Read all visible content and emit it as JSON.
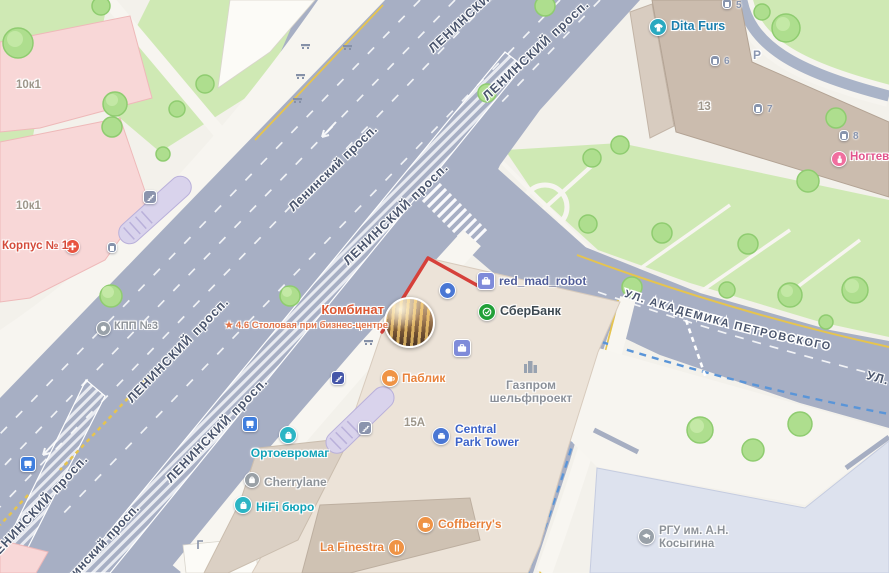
{
  "map_title": "Yandex-style city map, Leninsky Prospekt intersection",
  "roads": {
    "leninsky_caps": "ЛЕНИНСКИЙ просп.",
    "leninsky_title": "Ленинский просп.",
    "leninsky_short": "ЛЕНИНСКИЙ",
    "petrovskogo": "УЛ. АКАДЕМИКА ПЕТРОВСКОГО",
    "ul_fragment": "УЛ."
  },
  "pois": {
    "dita_furs": {
      "label": "Dita Furs"
    },
    "nail_studio": {
      "label": "Ногтевая"
    },
    "red_mad_robot": {
      "label": "red_mad_robot"
    },
    "sberbank": {
      "label": "СберБанк"
    },
    "kombinat": {
      "title": "Комбинат",
      "star": "★",
      "rating": "4.6",
      "subtitle": "Столовая при бизнес-центре"
    },
    "pablik": {
      "label": "Паблик"
    },
    "gazprom": {
      "line1": "Газпром",
      "line2": "шельфпроект"
    },
    "central_park_tower": {
      "line1": "Central",
      "line2": "Park Tower"
    },
    "ortoevromag": {
      "label": "Ортоевромаг"
    },
    "cherrylane": {
      "label": "Cherrylane"
    },
    "hifi_buro": {
      "label": "HiFi бюро"
    },
    "coffberrys": {
      "label": "Coffberry's"
    },
    "la_finestra": {
      "label": "La Finestra"
    },
    "rgu_kosygina": {
      "line1": "РГУ им. А.Н.",
      "line2": "Косыгина"
    },
    "kpp3": {
      "label": "КПП №3"
    },
    "korpus1": {
      "label": "Корпус № 1"
    }
  },
  "buildings": {
    "b13": "13",
    "b15a": "15А",
    "b10k1": "10к1",
    "b10k1_2": "10к1",
    "parking": "P",
    "entrances": [
      "5",
      "6",
      "7",
      "8"
    ]
  },
  "colors": {
    "road": "#a7afc4",
    "park": "#cfe9b4",
    "building_beige": "#ece3d8",
    "building_brown": "#cbbcae",
    "building_pink": "#f8d7d7",
    "building_blue_grey": "#dde2ee",
    "selection_red": "#d6403a",
    "lane_yellow": "#e6c44e",
    "bike_blue": "#5a95d8",
    "poi_food": "#e8813a",
    "poi_shop": "#12a3b8",
    "poi_transit_blue": "#3f7ede",
    "sber_green": "#21a038"
  }
}
